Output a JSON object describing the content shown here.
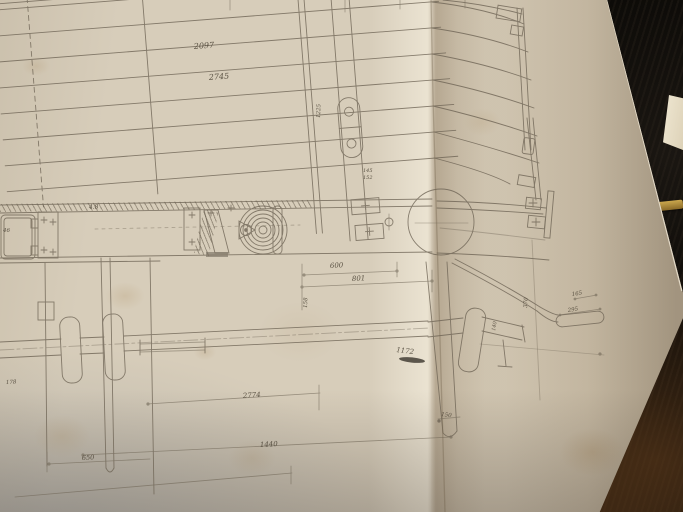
{
  "scene": {
    "paper_color": "#d7cdba",
    "line_color": "#6e6455",
    "background_leather": "#0d0b08",
    "cover_brown": "#5c3a1c",
    "brass_color": "#ad8a3c",
    "inserted_page_color": "#efe7d2"
  },
  "drawing": {
    "labels": {
      "dim_2097": "2097",
      "dim_2745": "2745",
      "dim_1225": "1225",
      "dim_145": "145",
      "dim_152": "152",
      "dim_48": "4.8",
      "dim_46": "46",
      "dim_600": "600",
      "dim_801": "801",
      "dim_158": "158",
      "dim_2774": "2774",
      "dim_1440": "1440",
      "dim_650": "650",
      "dim_1172": "1172",
      "dim_178": "178",
      "dim_150": "150",
      "dim_165": "165",
      "dim_295": "295",
      "dim_370": "370",
      "dim_140": "140"
    }
  }
}
